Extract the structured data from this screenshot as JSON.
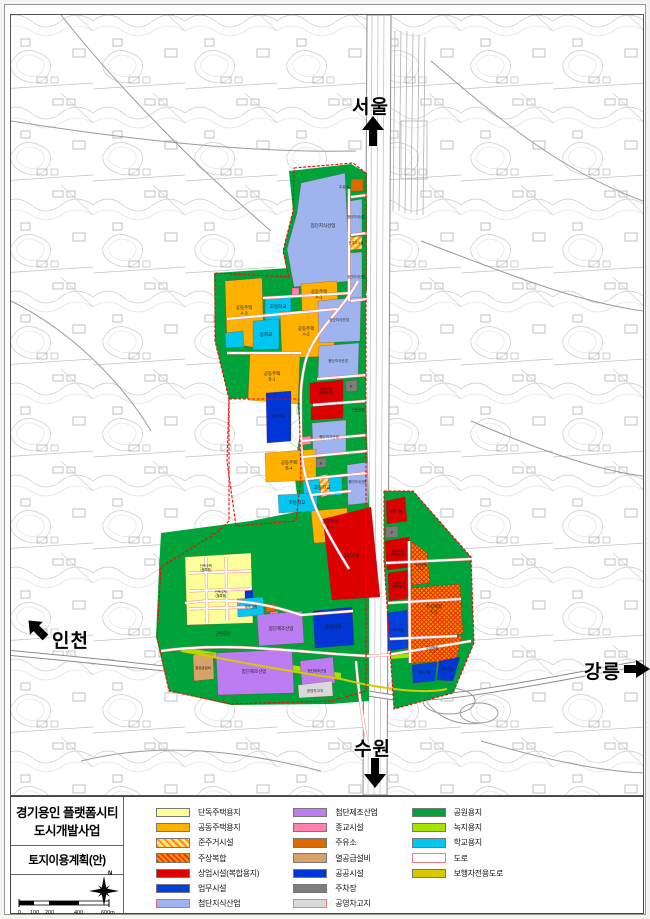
{
  "title_block": {
    "title_line1": "경기용인 플랫폼시티",
    "title_line2": "도시개발사업",
    "subtitle": "토지이용계획(안)",
    "north_label": "N",
    "scale_ticks": [
      "0",
      "100",
      "200",
      "400",
      "600m"
    ]
  },
  "palette": {
    "detached": "#ffff99",
    "apartment": "#ffb100",
    "semi_base": "#ffdf80",
    "semi_stripe": "#ff9100",
    "mixed_base": "#ff8a00",
    "mixed_stripe": "#e03000",
    "commercial": "#dd0000",
    "business": "#0040dd",
    "knowledge": "#9fb3ee",
    "manufacture": "#bd7df2",
    "religion": "#ff7fae",
    "gas": "#db6a00",
    "heat": "#d9a368",
    "public": "#0036d6",
    "parking": "#7d7d7d",
    "depot": "#d9d9d9",
    "park": "#00a33a",
    "greenery": "#a6e400",
    "school": "#00c6f0",
    "road": "#ffffff",
    "road_border": "#f08080",
    "pedestrian": "#d6c900",
    "boundary": "#ff0000"
  },
  "map": {
    "direction_labels": [
      {
        "id": "seoul",
        "label": "서울"
      },
      {
        "id": "incheon",
        "label": "인천"
      },
      {
        "id": "gangneung",
        "label": "강릉"
      },
      {
        "id": "suwon",
        "label": "수원"
      }
    ],
    "zones": [
      {
        "t": "park",
        "p": "288,170 350,163 366,172 366,290 350,294 290,293 282,250 292,210"
      },
      {
        "t": "park",
        "p": "213,272 362,262 365,300 365,422 300,422 296,396 228,398 214,340"
      },
      {
        "t": "park",
        "p": "296,396 365,392 368,508 340,510 298,510 293,470 299,432"
      },
      {
        "t": "park",
        "p": "160,532 250,520 300,510 368,502 368,700 330,703 230,704 168,690 155,636 158,568"
      },
      {
        "t": "park",
        "p": "383,490 412,490 470,556 473,642 452,692 393,708 383,560"
      },
      {
        "t": "greenery",
        "p": "180,646 340,672 340,677 180,651"
      },
      {
        "t": "greenery",
        "p": "390,654 455,649 455,653 390,658"
      },
      {
        "t": "knowledge",
        "p": "300,182 344,172 349,280 293,286 286,248 296,212",
        "l": "첨단지식산업",
        "lx": 322,
        "ly": 226
      },
      {
        "t": "gas",
        "p": "350,178 362,178 362,190 350,190",
        "l": "주유소",
        "lx": 343,
        "ly": 187,
        "ls": 3.6
      },
      {
        "t": "knowledge",
        "p": "349,200 361,198 361,232 349,233",
        "l": "첨단지식산업",
        "lx": 355,
        "ly": 217,
        "ls": 3.2
      },
      {
        "t": "semi_res",
        "p": "349,236 361,235 361,248 349,249",
        "l": "준주거시설",
        "lx": 355,
        "ly": 243,
        "ls": 3.2
      },
      {
        "t": "knowledge",
        "p": "349,252 361,251 361,298 349,299",
        "l": "첨단지식산업",
        "lx": 355,
        "ly": 277,
        "ls": 3.2
      },
      {
        "t": "apartment",
        "p": "300,283 336,280 337,308 301,310",
        "l": "공동주택|A-1",
        "lx": 318,
        "ly": 292
      },
      {
        "t": "religion",
        "p": "291,287 298,287 298,294 291,294"
      },
      {
        "t": "school",
        "p": "264,296 290,294 290,318 264,319",
        "l": "초등학교",
        "lx": 277,
        "ly": 307
      },
      {
        "t": "apartment",
        "p": "224,280 261,277 263,348 226,342",
        "l": "공동주택|A-3",
        "lx": 243,
        "ly": 308
      },
      {
        "t": "school",
        "p": "252,320 278,318 278,348 252,349",
        "l": "중학교",
        "lx": 265,
        "ly": 335
      },
      {
        "t": "apartment",
        "p": "279,311 331,308 334,355 281,357",
        "l": "공동주택|A-2",
        "lx": 305,
        "ly": 329
      },
      {
        "t": "school",
        "p": "224,332 242,330 243,346 225,347"
      },
      {
        "t": "apartment",
        "p": "249,351 299,353 297,403 247,399",
        "l": "공동주택|B-1",
        "lx": 271,
        "ly": 374
      },
      {
        "t": "knowledge",
        "p": "317,300 360,296 359,340 318,342",
        "l": "첨단지식산업",
        "lx": 338,
        "ly": 320,
        "ls": 3.6
      },
      {
        "t": "knowledge",
        "p": "318,345 358,342 357,376 317,378",
        "l": "첨단지식산업",
        "lx": 337,
        "ly": 361,
        "ls": 3.6
      },
      {
        "t": "commercial",
        "p": "309,382 342,379 342,400 309,403",
        "l": "상업시설|(복합용지)",
        "lx": 325,
        "ly": 389,
        "ls": 3.4
      },
      {
        "t": "commercial",
        "p": "310,406 342,403 342,417 310,419"
      },
      {
        "t": "parking",
        "p": "345,380 356,379 356,390 345,391",
        "l": "P",
        "lx": 350,
        "ly": 387,
        "ls": 4
      },
      {
        "t": "public",
        "p": "265,392 290,390 290,440 266,442",
        "l": "공공시설",
        "lx": 277,
        "ly": 416,
        "ls": 3.6
      },
      {
        "t": "knowledge",
        "p": "311,422 345,419 345,452 312,454",
        "l": "첨단지식산업",
        "lx": 328,
        "ly": 437,
        "ls": 3.6
      },
      {
        "t": "religion",
        "p": "301,436 310,435 310,443 301,444"
      },
      {
        "t": "parking",
        "p": "315,458 325,457 325,466 315,467",
        "l": "P",
        "lx": 320,
        "ly": 464,
        "ls": 4
      },
      {
        "t": "apartment",
        "p": "264,452 315,448 315,479 265,481",
        "l": "공동주택|B-4",
        "lx": 288,
        "ly": 463
      },
      {
        "t": "school",
        "p": "302,480 341,476 341,494 303,496",
        "l": "고등학교",
        "lx": 321,
        "ly": 488
      },
      {
        "t": "school",
        "p": "277,494 316,492 316,510 278,512",
        "l": "초등학교",
        "lx": 296,
        "ly": 503
      },
      {
        "t": "apartment",
        "p": "310,510 346,507 349,540 313,542",
        "l": "공동주택|B-2",
        "lx": 329,
        "ly": 522
      },
      {
        "t": "knowledge",
        "p": "346,464 367,461 367,502 347,504",
        "l": "첨단지식산업",
        "lx": 356,
        "ly": 482,
        "ls": 3.2
      },
      {
        "t": "semi_res",
        "p": "318,475 327,473 329,494 320,496"
      },
      {
        "t": "commercial",
        "p": "322,518 370,506 379,596 331,599",
        "l": "상업시설",
        "lx": 350,
        "ly": 556
      },
      {
        "t": "commercial",
        "p": "385,500 404,496 406,520 386,523",
        "l": "상업시설",
        "lx": 395,
        "ly": 511,
        "ls": 3.4
      },
      {
        "t": "parking",
        "p": "385,526 397,525 397,536 385,537",
        "l": "P",
        "lx": 391,
        "ly": 533,
        "ls": 4
      },
      {
        "t": "commercial",
        "p": "384,540 408,536 410,566 386,569",
        "l": "상업시설|(복합용지)",
        "lx": 397,
        "ly": 551,
        "ls": 3.4
      },
      {
        "t": "mixed_use",
        "p": "410,540 426,552 429,582 411,584",
        "l": "주상복합|C-1",
        "lx": 420,
        "ly": 565,
        "ls": 3.4
      },
      {
        "t": "commercial",
        "p": "387,572 408,569 409,597 388,600",
        "l": "상업시설|(복합용지)",
        "lx": 398,
        "ly": 583,
        "ls": 3.4
      },
      {
        "t": "mixed_use",
        "p": "410,587 459,583 462,633 410,636",
        "l": "주상복합|C-2",
        "lx": 433,
        "ly": 607
      },
      {
        "t": "business",
        "p": "386,612 406,609 407,647 387,650",
        "l": "업무시설",
        "lx": 396,
        "ly": 630,
        "ls": 3.6
      },
      {
        "t": "pedestrian",
        "p": "407,610 409.5,610 409.5,650 407,650"
      },
      {
        "t": "mixed_use",
        "p": "410,638 461,635 455,660 410,662",
        "l": "주상복합|C-3",
        "lx": 431,
        "ly": 648,
        "ls": 3.4
      },
      {
        "t": "business",
        "p": "411,664 436,661 434,680 412,682",
        "l": "업무시설",
        "lx": 423,
        "ly": 672,
        "ls": 3.4
      },
      {
        "t": "public",
        "p": "438,660 459,656 452,680 436,679",
        "l": "공공시설",
        "lx": 446,
        "ly": 669,
        "ls": 3.2
      },
      {
        "t": "detached",
        "p": "184,556 250,552 252,622 186,624"
      },
      {
        "t": "public",
        "p": "244,590 252,589 252,598 244,599"
      },
      {
        "t": "school",
        "p": "236,598 262,596 263,614 237,616",
        "l": "체육공원",
        "lx": 250,
        "ly": 607,
        "ls": 3.4
      },
      {
        "t": "gas",
        "p": "265,604 274,603 274,610 265,611"
      },
      {
        "t": "religion",
        "p": "269,611 277,610 277,617 269,618"
      },
      {
        "t": "manufacture",
        "p": "256,614 301,610 303,642 258,645",
        "l": "첨단제조산업",
        "lx": 280,
        "ly": 629
      },
      {
        "t": "public",
        "p": "312,610 351,606 353,644 314,647",
        "l": "공공시설",
        "lx": 332,
        "ly": 627
      },
      {
        "t": "heat",
        "p": "192,654 212,652 213,678 193,680",
        "l": "열공급설비",
        "lx": 202,
        "ly": 668,
        "ls": 3.4
      },
      {
        "t": "manufacture",
        "p": "215,652 291,648 293,692 217,694",
        "l": "첨단제조산업",
        "lx": 253,
        "ly": 672
      },
      {
        "t": "manufacture",
        "p": "299,660 332,656 334,682 301,684",
        "l": "첨단제조산업",
        "lx": 316,
        "ly": 671,
        "ls": 3.4
      },
      {
        "t": "depot",
        "p": "297,684 331,680 332,695 298,697",
        "l": "공영차고지",
        "lx": 314,
        "ly": 691,
        "ls": 3.6
      }
    ],
    "labels": [
      {
        "t": "근린공원",
        "x": 222,
        "y": 634,
        "s": 4.2
      },
      {
        "t": "근린공원",
        "x": 357,
        "y": 410,
        "s": 3.6
      },
      {
        "t": "단독주택|(블록형)",
        "x": 205,
        "y": 566,
        "s": 3.2
      },
      {
        "t": "단독주택|(블록형)",
        "x": 220,
        "y": 592,
        "s": 3.2
      }
    ],
    "roads": [
      "M357,280 C340,312 312,330 304,362 C298,388 300,402 300,434 C300,464 306,486 316,510 C326,532 336,548 348,568",
      "M350,292 L262,297",
      "M336,308 L226,318",
      "M300,352 L226,352",
      "M316,378 L366,374",
      "M312,404 L365,400",
      "M300,440 L366,434",
      "M302,456 L366,450",
      "M306,478 L366,472",
      "M310,494 L350,490",
      "M160,650 C230,640 300,652 368,655 L386,654 L470,640",
      "M184,602 C230,596 264,602 300,614 L352,610",
      "M355,660 C358,700 364,730 367,748",
      "M385,562 L470,558",
      "M387,602 L460,598",
      "M388,638 L456,635",
      "M408,540 L409,662",
      "M350,196 L366,194",
      "M350,234 L366,232",
      "M350,300 L366,298",
      "M348,188 L348,300",
      "M188,572 L250,570",
      "M188,590 L250,588",
      "M188,608 L252,606",
      "M205,556 L206,622",
      "M225,556 L226,620"
    ],
    "pedestrian_path": "M182,650 C240,662 300,672 340,678 C372,686 420,694 446,688",
    "boundary_paths": [
      "M293,167 L352,162 L365,172 L365,690 L330,700 L230,703 L168,690 L156,636 L160,566 L215,532 L228,520 L228,398 L214,340 L214,272 L288,276 L282,250 L292,210 Z",
      "M383,490 L412,490 L470,556 L473,642 L452,692 L393,708 L383,560 Z",
      "M228,398 L298,398 L300,475 L295,520 L235,525 L226,460 Z"
    ]
  },
  "legend": {
    "columns": [
      [
        {
          "label": "단독주택용지",
          "key": "detached"
        },
        {
          "label": "공동주택용지",
          "key": "apartment"
        },
        {
          "label": "준주거시설",
          "key": "semi_res",
          "pattern": "hatch"
        },
        {
          "label": "주상복합",
          "key": "mixed_use",
          "pattern": "cross"
        },
        {
          "label": "상업시설(복합용지)",
          "key": "commercial"
        },
        {
          "label": "업무시설",
          "key": "business"
        },
        {
          "label": "첨단지식산업",
          "key": "knowledge",
          "border": "#e06868"
        }
      ],
      [
        {
          "label": "첨단제조산업",
          "key": "manufacture"
        },
        {
          "label": "종교시설",
          "key": "religion"
        },
        {
          "label": "주유소",
          "key": "gas"
        },
        {
          "label": "열공급설비",
          "key": "heat"
        },
        {
          "label": "공공시설",
          "key": "public"
        },
        {
          "label": "주차장",
          "key": "parking"
        },
        {
          "label": "공영차고지",
          "key": "depot",
          "border": "#f08080"
        }
      ],
      [
        {
          "label": "공원용지",
          "key": "park"
        },
        {
          "label": "녹지용지",
          "key": "greenery"
        },
        {
          "label": "학교용지",
          "key": "school"
        },
        {
          "label": "도로",
          "key": "road",
          "border": "#f08080"
        },
        {
          "label": "보행자전용도로",
          "key": "pedestrian"
        }
      ]
    ]
  }
}
